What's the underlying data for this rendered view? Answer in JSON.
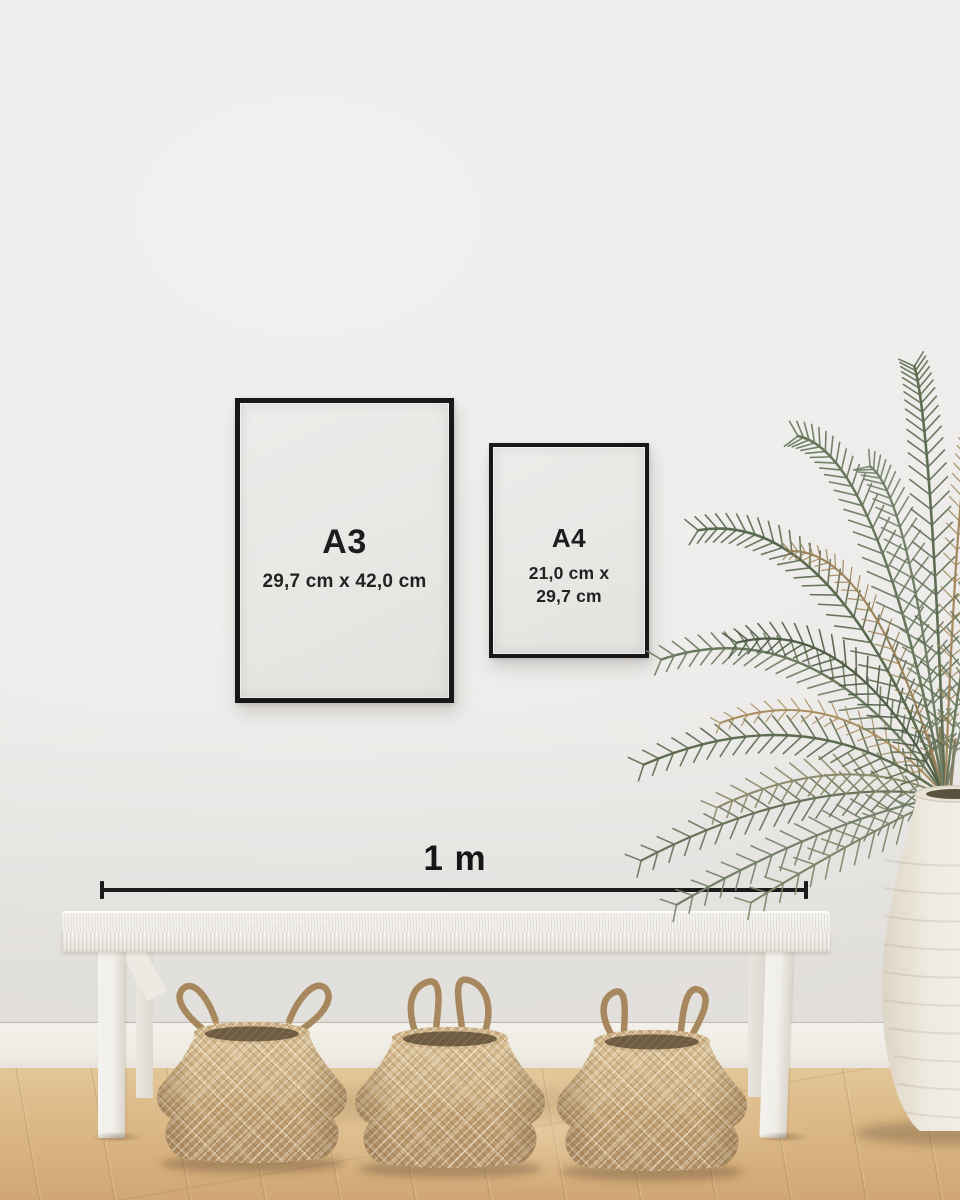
{
  "frames": {
    "a3": {
      "label": "A3",
      "dimensions": "29,7 cm x 42,0 cm"
    },
    "a4": {
      "label": "A4",
      "dimensions_line1": "21,0 cm x",
      "dimensions_line2": "29,7 cm"
    }
  },
  "scale_bar": {
    "label": "1 m"
  },
  "scene_objects": {
    "frame_a3": "black-framed-poster-a3",
    "frame_a4": "black-framed-poster-a4",
    "bench": "white-woven-bench",
    "baskets": [
      "seagrass-belly-basket",
      "seagrass-belly-basket",
      "seagrass-belly-basket"
    ],
    "plant": "dried-palm-plant",
    "vase": "white-clay-urn"
  },
  "colors": {
    "wall": "#efeeec",
    "frame": "#18181b",
    "paper": "#e9e8e5",
    "text": "#1b1b1b",
    "floor_light": "#e3c697",
    "floor_dark": "#d0a674",
    "basket": "#c6a77c",
    "bench": "#f3f1ed",
    "vase": "#efeae1",
    "plant_green": "#67765b",
    "plant_dried": "#a3885d"
  }
}
